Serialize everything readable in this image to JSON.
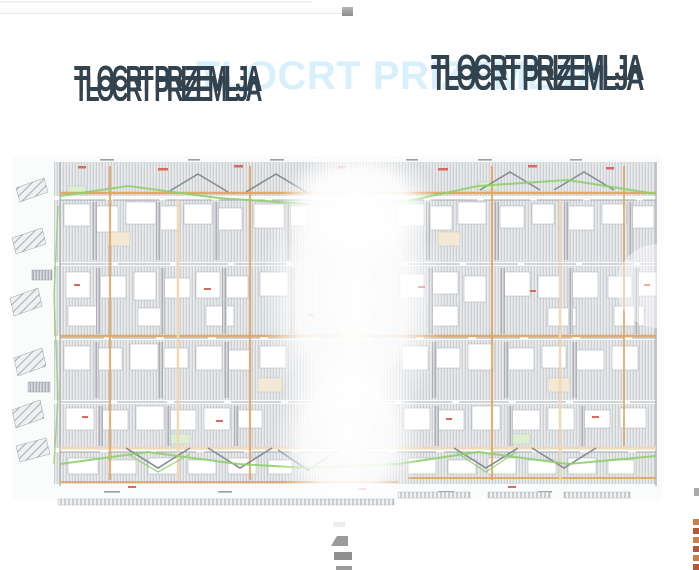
{
  "titles": {
    "watermark_text": "TLOCRT PRIZEMLJA",
    "left_text": "TLOCRT PRIZEMLJA",
    "right_text": "TLOCRT PRIZEMLJA"
  },
  "colors": {
    "title_dark": "#33424f",
    "title_watermark": "#d8f0fb",
    "hatch_line": "#b9bdc3",
    "hatch_bg": "#e9ebed",
    "hatch_dark_line": "#989ea5",
    "hatch_dark_bg": "#d9dbde",
    "wall_orange": "#dfa35f",
    "wall_tan": "#edd9b4",
    "landscape_green": "#8ed06a",
    "marker_red": "#dc6a5c",
    "outline_gray": "#8f959b",
    "edge_orange": "#cd7f49",
    "edge_rust": "#b85438"
  }
}
